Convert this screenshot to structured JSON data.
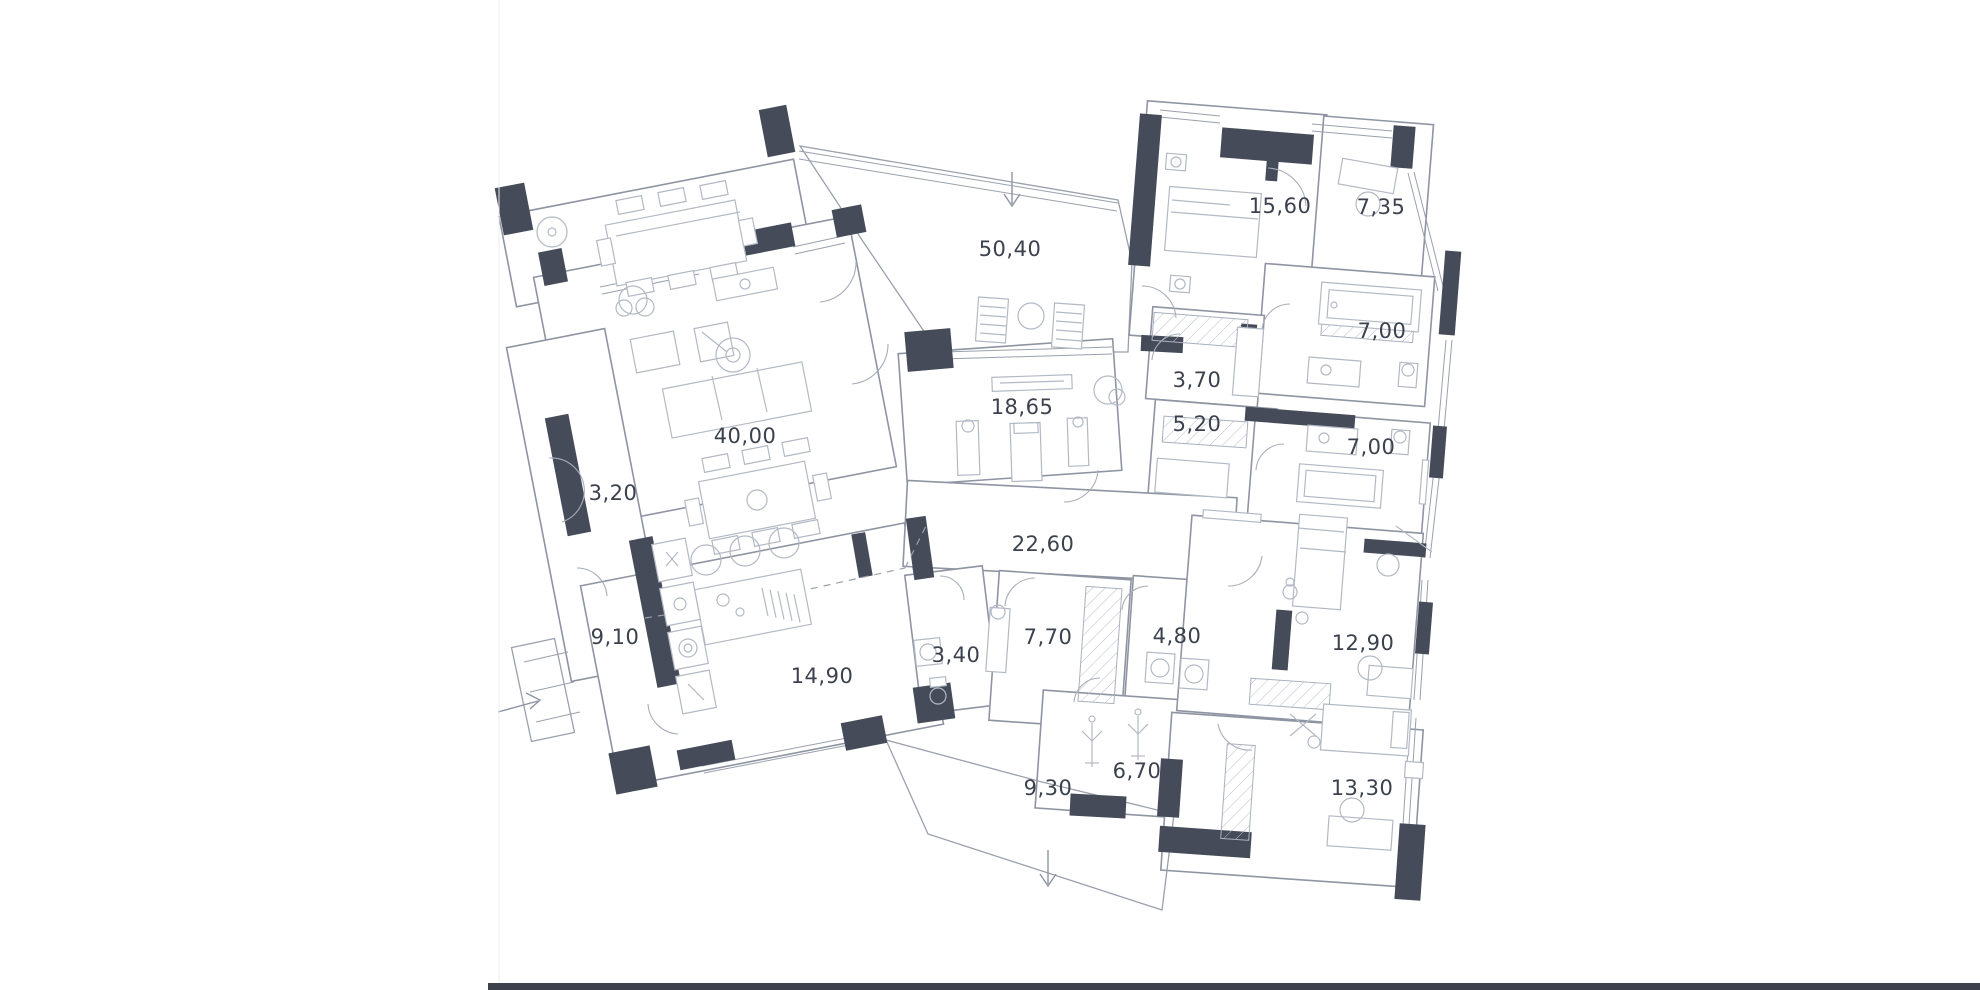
{
  "page": {
    "background": "#ffffff",
    "left_page_border_color": "#ececec",
    "footer_rule_color": "#3c414c"
  },
  "plan": {
    "type": "residential-floor-plan",
    "wall_accent_color": "#454b59",
    "line_color": "#8e94a2",
    "label_color": "#3b414d",
    "area_unit_style": "comma-decimal",
    "rooms": [
      {
        "name": "terrace-upper",
        "area": "50,40",
        "x": 1010,
        "y": 256
      },
      {
        "name": "master-bedroom",
        "area": "15,60",
        "x": 1280,
        "y": 213
      },
      {
        "name": "cabinet",
        "area": "7,35",
        "x": 1381,
        "y": 214
      },
      {
        "name": "bathroom-1",
        "area": "7,00",
        "x": 1382,
        "y": 338
      },
      {
        "name": "pantry",
        "area": "3,70",
        "x": 1197,
        "y": 387
      },
      {
        "name": "dressing-room",
        "area": "5,20",
        "x": 1197,
        "y": 431
      },
      {
        "name": "bathroom-2",
        "area": "7,00",
        "x": 1371,
        "y": 454
      },
      {
        "name": "gym",
        "area": "18,65",
        "x": 1022,
        "y": 414
      },
      {
        "name": "living-room",
        "area": "40,00",
        "x": 745,
        "y": 443
      },
      {
        "name": "entry-hall",
        "area": "3,20",
        "x": 613,
        "y": 500
      },
      {
        "name": "corridor",
        "area": "22,60",
        "x": 1043,
        "y": 551
      },
      {
        "name": "kids-bedroom-1",
        "area": "12,90",
        "x": 1363,
        "y": 650
      },
      {
        "name": "hallway",
        "area": "9,10",
        "x": 615,
        "y": 644
      },
      {
        "name": "kitchen",
        "area": "14,90",
        "x": 822,
        "y": 683
      },
      {
        "name": "wc",
        "area": "3,40",
        "x": 956,
        "y": 662
      },
      {
        "name": "mudroom",
        "area": "7,70",
        "x": 1048,
        "y": 644
      },
      {
        "name": "laundry",
        "area": "4,80",
        "x": 1177,
        "y": 643
      },
      {
        "name": "wardrobe-room",
        "area": "6,70",
        "x": 1137,
        "y": 778
      },
      {
        "name": "kids-bedroom-2",
        "area": "13,30",
        "x": 1362,
        "y": 795
      },
      {
        "name": "terrace-lower",
        "area": "9,30",
        "x": 1048,
        "y": 795
      }
    ],
    "annotations": [
      {
        "name": "terrace-entrance-arrow"
      },
      {
        "name": "lower-terrace-entrance-arrow"
      },
      {
        "name": "porch-entrance-arrow"
      }
    ]
  }
}
